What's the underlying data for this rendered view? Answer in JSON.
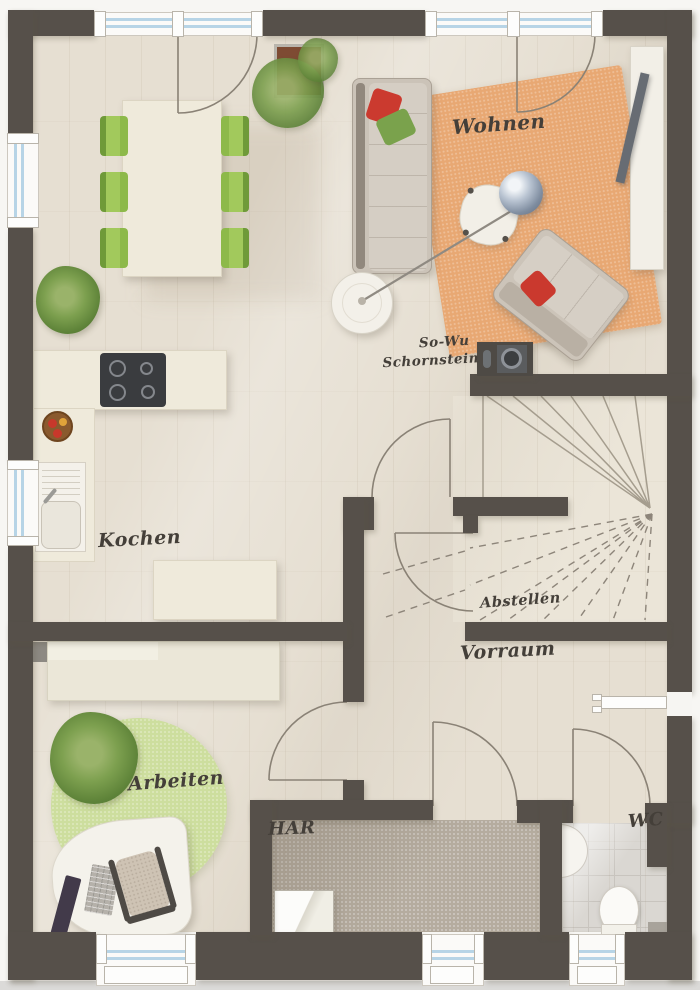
{
  "labels": {
    "wohnen": "Wohnen",
    "kochen": "Kochen",
    "arbeiten": "Arbeiten",
    "vorraum": "Vorraum",
    "abstellen": "Abstellen",
    "har": "HAR",
    "wc": "WC",
    "chimney_line1": "So-Wu",
    "chimney_line2": "Schornstein"
  },
  "colors": {
    "wall": "#56504a",
    "floor_wood": "#e6dfd2",
    "stair_floor": "#ebe5d8",
    "rug_living": "#e8a873",
    "rug_office": "#cdde9e",
    "chair_green": "#a2c95c",
    "pillow_red": "#cb3a2f",
    "pillow_green": "#7aa24c",
    "har_floor": "#b5ac9f",
    "wc_floor": "#dad7d2",
    "furniture_cream": "#efeadb",
    "glass": "#b7d4e6",
    "label_ink": "#443f39"
  }
}
